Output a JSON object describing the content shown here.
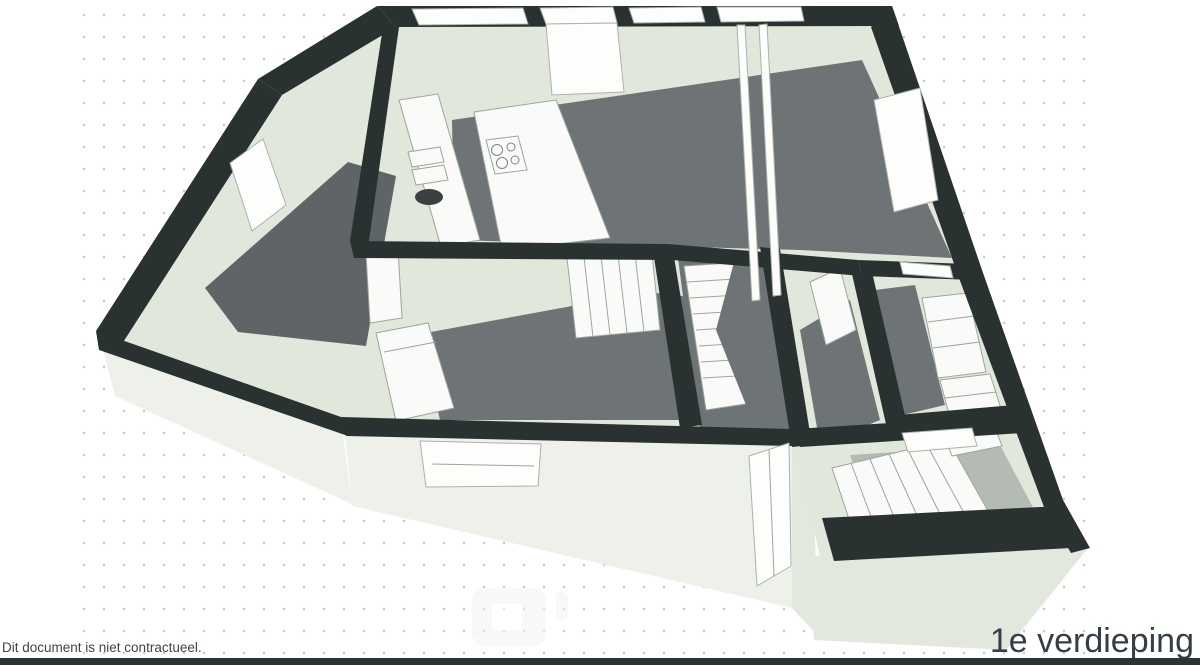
{
  "page": {
    "floor_label": "1e verdieping",
    "disclaimer": "Dit document is niet contractueel."
  },
  "palette": {
    "background": "#ffffff",
    "dot": "#c8cdcc",
    "wall": "#2a3231",
    "wood": "#6e7475",
    "wood_dark": "#5f6566",
    "interior": "#e2e7dc",
    "face": "#eef1e9",
    "face_shadow": "#e3e8de",
    "furniture": "#fafbf8",
    "outline": "#9aa69d",
    "steps_gray": "#b4bab4",
    "bar": "#2b3434",
    "title_text": "#333e47",
    "caption_text": "#3d4549",
    "watermark": "#f3f5f1"
  }
}
